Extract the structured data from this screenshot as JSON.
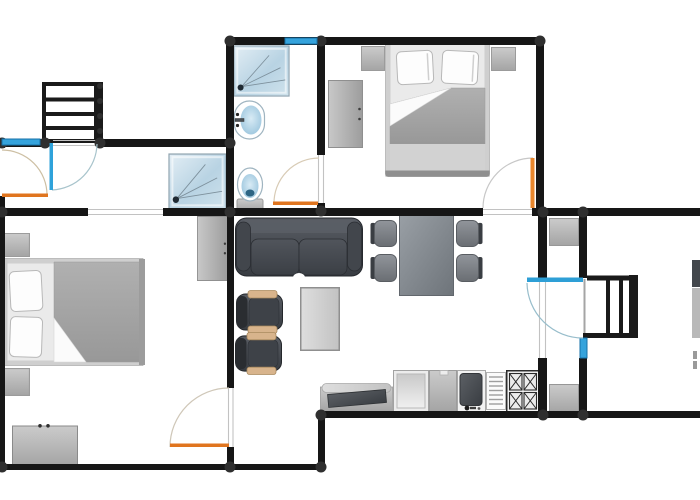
{
  "meta": {
    "kind": "apartment-floor-plan",
    "width": 700,
    "height": 500,
    "background": "#ffffff"
  },
  "colors": {
    "wall": "#161616",
    "wall_node": "#2f2f2f",
    "window_fill": "#35a3dc",
    "window_stroke": "#1572a8",
    "jamb": "#c2c2c2",
    "door_orange": "#e0751f",
    "door_blue": "#2e9fd6",
    "floor": "#ffffff"
  },
  "walls": [
    [
      226,
      37,
      317,
      8
    ],
    [
      226,
      37,
      8,
      179
    ],
    [
      317,
      43,
      8,
      112
    ],
    [
      317,
      203,
      8,
      13
    ],
    [
      536,
      37,
      8,
      179
    ],
    [
      0,
      139,
      44,
      8
    ],
    [
      98,
      139,
      130,
      8
    ],
    [
      0,
      208,
      88,
      8
    ],
    [
      163,
      208,
      320,
      8
    ],
    [
      532,
      208,
      168,
      8
    ],
    [
      0,
      139,
      5,
      9
    ],
    [
      0,
      196,
      5,
      274
    ],
    [
      227,
      216,
      7,
      172
    ],
    [
      227,
      447,
      7,
      23
    ],
    [
      0,
      464,
      325,
      6
    ],
    [
      318,
      413,
      7,
      57
    ],
    [
      318,
      411,
      382,
      7
    ],
    [
      538,
      216,
      9,
      62
    ],
    [
      538,
      358,
      9,
      58
    ],
    [
      579,
      216,
      8,
      62
    ],
    [
      579,
      358,
      8,
      58
    ]
  ],
  "dots": [
    [
      2,
      143,
      5.5
    ],
    [
      45,
      143,
      5.5
    ],
    [
      100,
      143,
      5.5
    ],
    [
      230,
      41,
      5.5
    ],
    [
      321,
      41,
      5.5
    ],
    [
      540,
      41,
      5.5
    ],
    [
      230,
      143,
      5.5
    ],
    [
      2,
      212,
      5.5
    ],
    [
      230,
      212,
      5.5
    ],
    [
      321,
      211,
      5.5
    ],
    [
      543,
      212,
      5.5
    ],
    [
      583,
      212,
      5.5
    ],
    [
      2,
      467,
      5.5
    ],
    [
      230,
      467,
      5.5
    ],
    [
      321,
      415,
      5.5
    ],
    [
      321,
      467,
      5.5
    ],
    [
      543,
      415,
      5.5
    ],
    [
      583,
      415,
      5.5
    ],
    [
      100,
      86,
      3
    ],
    [
      100,
      101,
      3
    ],
    [
      100,
      116,
      3
    ],
    [
      100,
      131,
      3
    ]
  ],
  "windows": [
    {
      "name": "window-hall",
      "x": 2,
      "y": 139,
      "w": 38,
      "h": 6
    },
    {
      "name": "window-bathroom",
      "x": 285,
      "y": 38,
      "w": 32,
      "h": 6
    },
    {
      "name": "window-stair-room",
      "x": 580,
      "y": 338,
      "w": 7,
      "h": 20
    }
  ],
  "jambs": [
    [
      88,
      209.5,
      163,
      209.5
    ],
    [
      88,
      214.5,
      163,
      214.5
    ],
    [
      483,
      209.5,
      532,
      209.5
    ],
    [
      483,
      214.5,
      532,
      214.5
    ],
    [
      228.5,
      388,
      228.5,
      447
    ],
    [
      233,
      388,
      233,
      447
    ],
    [
      318.5,
      155,
      318.5,
      203
    ],
    [
      323.5,
      155,
      323.5,
      203
    ],
    [
      539.5,
      278,
      539.5,
      358
    ],
    [
      545.5,
      278,
      545.5,
      358
    ],
    [
      53,
      140.5,
      98,
      140.5
    ],
    [
      53,
      145.5,
      98,
      145.5
    ]
  ],
  "doors": [
    {
      "name": "entry-door-left",
      "leaf": [
        2,
        193.5,
        46,
        3.5
      ],
      "leaf_color": "#e0751f",
      "arc": "M47,195 A45,45 0 0 0 2,150",
      "arc_color": "#cdbfa3"
    },
    {
      "name": "entry-door-top",
      "leaf": [
        49.5,
        143,
        3.5,
        47
      ],
      "leaf_color": "#2ea2da",
      "arc": "M52,190 A47,47 0 0 0 97,144",
      "arc_color": "#a8c4cc"
    },
    {
      "name": "bathroom-door",
      "leaf": [
        273,
        201.5,
        45,
        3.5
      ],
      "leaf_color": "#e0751f",
      "arc": "M274,204 A45,45 0 0 1 319,158",
      "arc_color": "#d8cbb5"
    },
    {
      "name": "bedroom-door",
      "leaf": [
        530.5,
        158,
        4,
        50
      ],
      "leaf_color": "#e8862c",
      "arc": "M483,208 A50,50 0 0 1 533,158",
      "arc_color": "#c7c7c7"
    },
    {
      "name": "left-room-door",
      "leaf": [
        170,
        443.5,
        59,
        3.5
      ],
      "leaf_color": "#e0751f",
      "arc": "M170,447 A59,59 0 0 1 229,388",
      "arc_color": "#cfc7b8"
    },
    {
      "name": "glass-door-right",
      "leaf": [
        527,
        277.5,
        56,
        4.5
      ],
      "leaf_color": "#2e9fd6",
      "arc": "M527,283 A56,56 0 0 0 583,338",
      "arc_color": "#97bdcb"
    }
  ],
  "furniture": [
    {
      "type": "stairs-h",
      "name": "staircase-entry",
      "x": 42,
      "y": 82,
      "w": 61,
      "h": 61
    },
    {
      "type": "shower",
      "name": "shower-bathroom",
      "x": 233,
      "y": 45,
      "w": 57,
      "h": 52
    },
    {
      "type": "shower",
      "name": "shower-hall",
      "x": 168,
      "y": 153,
      "w": 59,
      "h": 57
    },
    {
      "type": "sink-bath",
      "name": "bathroom-sink",
      "x": 234,
      "y": 100,
      "w": 32,
      "h": 40
    },
    {
      "type": "toilet",
      "name": "toilet",
      "x": 236,
      "y": 167,
      "w": 28,
      "h": 45
    },
    {
      "type": "wardrobe",
      "name": "wardrobe-bedroom",
      "x": 328,
      "y": 80,
      "w": 35,
      "h": 68
    },
    {
      "type": "nightstand",
      "name": "nightstand-left",
      "x": 361,
      "y": 46,
      "w": 24,
      "h": 25
    },
    {
      "type": "nightstand",
      "name": "nightstand-right",
      "x": 491,
      "y": 47,
      "w": 25,
      "h": 24
    },
    {
      "type": "bed-v",
      "name": "double-bed-top",
      "x": 385,
      "y": 41,
      "w": 105,
      "h": 136
    },
    {
      "type": "wardrobe",
      "name": "wardrobe-left-room",
      "x": 197,
      "y": 216,
      "w": 31,
      "h": 65
    },
    {
      "type": "nightstand",
      "name": "nightstand-a",
      "x": 2,
      "y": 233,
      "w": 28,
      "h": 24
    },
    {
      "type": "bed-h",
      "name": "double-bed-left",
      "x": 2,
      "y": 258,
      "w": 143,
      "h": 108
    },
    {
      "type": "nightstand",
      "name": "nightstand-b",
      "x": 2,
      "y": 368,
      "w": 28,
      "h": 28
    },
    {
      "type": "dresser",
      "name": "dresser",
      "x": 12,
      "y": 424,
      "w": 66,
      "h": 42
    },
    {
      "type": "sofa",
      "name": "sofa",
      "x": 235,
      "y": 217,
      "w": 128,
      "h": 61
    },
    {
      "type": "armchair",
      "name": "armchair-a",
      "x": 236,
      "y": 290,
      "w": 49,
      "h": 44
    },
    {
      "type": "armchair",
      "name": "armchair-b",
      "x": 235,
      "y": 332,
      "w": 49,
      "h": 43
    },
    {
      "type": "coffee-table",
      "name": "coffee-table",
      "x": 300,
      "y": 287,
      "w": 40,
      "h": 64
    },
    {
      "type": "dining-table",
      "name": "dining-table",
      "x": 399,
      "y": 215,
      "w": 55,
      "h": 81
    },
    {
      "type": "chair",
      "name": "dining-chair-1",
      "x": 370,
      "y": 220,
      "w": 27,
      "h": 27
    },
    {
      "type": "chair",
      "name": "dining-chair-2",
      "x": 370,
      "y": 254,
      "w": 27,
      "h": 28
    },
    {
      "type": "chair",
      "name": "dining-chair-3",
      "flip": true,
      "x": 456,
      "y": 220,
      "w": 27,
      "h": 27
    },
    {
      "type": "chair",
      "name": "dining-chair-4",
      "flip": true,
      "x": 456,
      "y": 254,
      "w": 27,
      "h": 28
    },
    {
      "type": "cabinet",
      "name": "cabinet-niche-top",
      "x": 549,
      "y": 218,
      "w": 30,
      "h": 28
    },
    {
      "type": "cabinet",
      "name": "cabinet-niche-bottom",
      "x": 549,
      "y": 384,
      "w": 30,
      "h": 29
    },
    {
      "type": "counter",
      "name": "kitchen-counter",
      "x": 320,
      "y": 383,
      "w": 73,
      "h": 29
    },
    {
      "type": "dishwasher",
      "name": "dishwasher",
      "x": 393,
      "y": 370,
      "w": 36,
      "h": 42
    },
    {
      "type": "fridge",
      "name": "fridge",
      "x": 429,
      "y": 370,
      "w": 28,
      "h": 42
    },
    {
      "type": "sink-unit",
      "name": "kitchen-sink",
      "x": 457,
      "y": 370,
      "w": 29,
      "h": 42
    },
    {
      "type": "drainer",
      "name": "dish-drainer",
      "x": 486,
      "y": 372,
      "w": 20,
      "h": 38
    },
    {
      "type": "stove",
      "name": "stove",
      "x": 506,
      "y": 370,
      "w": 34,
      "h": 43
    },
    {
      "type": "stairs-v",
      "name": "staircase-right",
      "x": 583,
      "y": 275,
      "w": 55,
      "h": 63
    }
  ],
  "marks": [
    {
      "name": "cut-chair",
      "x": 692,
      "y": 260,
      "w": 8,
      "h": 27,
      "fill": "#43474c"
    },
    {
      "name": "cut-table",
      "x": 692,
      "y": 288,
      "w": 8,
      "h": 50,
      "fill": "#b9b9b9"
    },
    {
      "name": "cut-mark-a",
      "x": 693,
      "y": 351,
      "w": 4,
      "h": 8,
      "fill": "#9a9a9a"
    },
    {
      "name": "cut-mark-b",
      "x": 693,
      "y": 361,
      "w": 4,
      "h": 8,
      "fill": "#9a9a9a"
    }
  ]
}
